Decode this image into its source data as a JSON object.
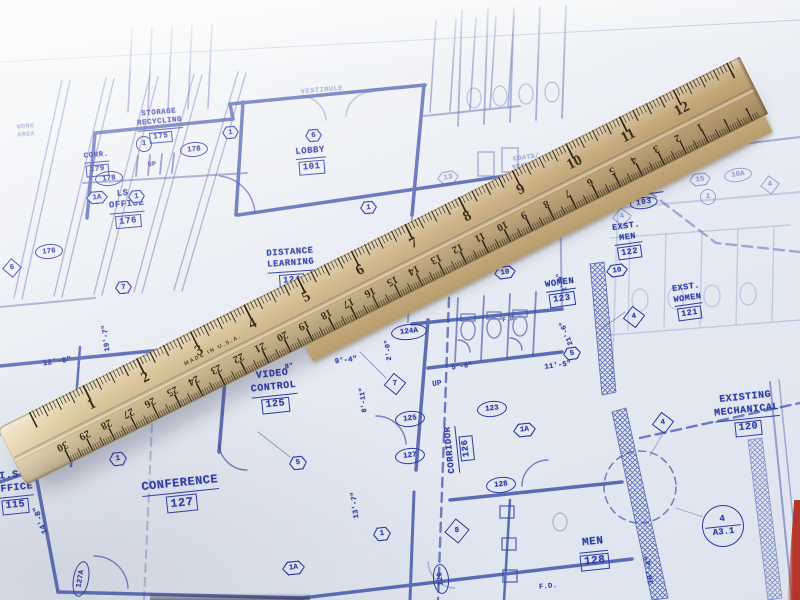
{
  "colors": {
    "paper": "#e8ecf4",
    "blueprint_line": "#3a4ea6",
    "blueprint_text": "#2b3ca6",
    "ruler_wood": "#d2bb8e",
    "ruler_wood_dark": "#b89c6e",
    "ruler_marking": "#33271a",
    "red_corner": "#b5352b"
  },
  "ruler": {
    "made_in": "MADE IN U.S.A.",
    "top_scale_numbers": [
      1,
      2,
      3,
      4,
      5,
      6,
      7,
      8,
      9,
      10,
      11,
      12
    ],
    "bottom_scale_numbers": [
      30,
      29,
      28,
      27,
      26,
      25,
      24,
      23,
      22,
      21,
      20,
      19,
      18,
      17,
      16,
      15,
      14,
      13,
      12,
      11,
      10,
      9,
      8,
      7,
      6,
      5,
      4,
      3,
      2,
      1
    ]
  },
  "blueprint": {
    "rooms": [
      {
        "lines": [
          "WORK",
          "AREA"
        ],
        "num": "",
        "num_style": "plain",
        "x": 26,
        "y": 131,
        "rot": -4,
        "size": 6.5,
        "faint": true
      },
      {
        "lines": [
          "STORAGE",
          "RECYCLING"
        ],
        "num": "175",
        "num_style": "box",
        "x": 160,
        "y": 126,
        "rot": -5,
        "size": 7.5,
        "faint": false
      },
      {
        "lines": [
          "CORR."
        ],
        "num": "179",
        "num_style": "box",
        "x": 97,
        "y": 164,
        "rot": -5,
        "size": 7.5,
        "faint": false
      },
      {
        "lines": [
          "LOBBY"
        ],
        "num": "101",
        "num_style": "box",
        "x": 311,
        "y": 160,
        "rot": -5,
        "size": 9,
        "faint": false
      },
      {
        "lines": [
          "VESTIBULE"
        ],
        "num": "",
        "num_style": "plain",
        "x": 322,
        "y": 91,
        "rot": -5,
        "size": 7,
        "faint": true
      },
      {
        "lines": [
          "LS.",
          "OFFICE"
        ],
        "num": "176",
        "num_style": "box",
        "x": 127,
        "y": 208,
        "rot": -5,
        "size": 9,
        "faint": false
      },
      {
        "lines": [
          "COATS/",
          "VENDING"
        ],
        "num": "",
        "num_style": "plain",
        "x": 527,
        "y": 162,
        "rot": -8,
        "size": 6.5,
        "faint": true
      },
      {
        "lines": [
          "DISTANCE",
          "LEARNING"
        ],
        "num": "124",
        "num_style": "box",
        "x": 291,
        "y": 267,
        "rot": -4,
        "size": 9,
        "faint": false
      },
      {
        "lines": [
          "VIDEO",
          "CONTROL"
        ],
        "num": "125",
        "num_style": "box",
        "x": 274,
        "y": 391,
        "rot": -6,
        "size": 10,
        "faint": false
      },
      {
        "lines": [
          "CONFERENCE"
        ],
        "num": "127",
        "num_style": "box",
        "x": 181,
        "y": 494,
        "rot": -6,
        "size": 12,
        "faint": false
      },
      {
        "lines": [
          "WOMEN"
        ],
        "num": "123",
        "num_style": "box",
        "x": 561,
        "y": 292,
        "rot": -8,
        "size": 9,
        "faint": false
      },
      {
        "lines": [
          "EXST.",
          "MEN"
        ],
        "num": "122",
        "num_style": "box",
        "x": 628,
        "y": 240,
        "rot": -8,
        "size": 8.5,
        "faint": false
      },
      {
        "lines": [
          "EXST.",
          "WOMEN"
        ],
        "num": "121",
        "num_style": "box",
        "x": 688,
        "y": 301,
        "rot": -8,
        "size": 8.5,
        "faint": false
      },
      {
        "lines": [
          "CORRIDOR"
        ],
        "num": "103",
        "num_style": "oval",
        "x": 643,
        "y": 196,
        "rot": -8,
        "size": 8,
        "faint": false
      },
      {
        "lines": [
          "EXISTING",
          "MECHANICAL"
        ],
        "num": "120",
        "num_style": "box",
        "x": 747,
        "y": 414,
        "rot": -6,
        "size": 10,
        "faint": false
      },
      {
        "lines": [
          "MEN"
        ],
        "num": "128",
        "num_style": "box",
        "x": 594,
        "y": 553,
        "rot": -6,
        "size": 11,
        "faint": false
      },
      {
        "lines": [
          "CORRIDOR"
        ],
        "num": "126",
        "num_style": "box",
        "x": 459,
        "y": 449,
        "rot": -96,
        "size": 9,
        "faint": false
      },
      {
        "lines": [
          "I.S.",
          "OFFICE"
        ],
        "num": "115",
        "num_style": "box",
        "x": 14,
        "y": 492,
        "rot": -6,
        "size": 10,
        "faint": false
      }
    ],
    "ref_tags": [
      {
        "shape": "oval",
        "text": "178",
        "x": 108,
        "y": 177,
        "w": 26,
        "h": 13,
        "rot": -5,
        "faint": false
      },
      {
        "shape": "oval",
        "text": "178",
        "x": 193,
        "y": 148,
        "w": 26,
        "h": 13,
        "rot": -5,
        "faint": false
      },
      {
        "shape": "oval",
        "text": "176",
        "x": 48,
        "y": 250,
        "w": 26,
        "h": 13,
        "rot": -5,
        "faint": false
      },
      {
        "shape": "oval",
        "text": "124A",
        "x": 408,
        "y": 331,
        "w": 34,
        "h": 14,
        "rot": -6,
        "faint": false
      },
      {
        "shape": "oval",
        "text": "125",
        "x": 409,
        "y": 418,
        "w": 28,
        "h": 14,
        "rot": -6,
        "faint": false
      },
      {
        "shape": "oval",
        "text": "127",
        "x": 409,
        "y": 455,
        "w": 28,
        "h": 14,
        "rot": -6,
        "faint": false
      },
      {
        "shape": "oval",
        "text": "123",
        "x": 491,
        "y": 408,
        "w": 28,
        "h": 14,
        "rot": -6,
        "faint": false
      },
      {
        "shape": "oval",
        "text": "128",
        "x": 500,
        "y": 484,
        "w": 28,
        "h": 14,
        "rot": -6,
        "faint": false
      },
      {
        "shape": "oval",
        "text": "126",
        "x": 440,
        "y": 578,
        "w": 28,
        "h": 14,
        "rot": -96,
        "faint": false
      },
      {
        "shape": "oval",
        "text": "127A",
        "x": 80,
        "y": 578,
        "w": 34,
        "h": 14,
        "rot": -80,
        "faint": false
      },
      {
        "shape": "oval",
        "text": "10A",
        "x": 737,
        "y": 174,
        "w": 26,
        "h": 12,
        "rot": -8,
        "faint": true
      },
      {
        "shape": "circle",
        "text": "1",
        "x": 143,
        "y": 143,
        "w": 14,
        "h": 14,
        "rot": 0,
        "faint": false
      },
      {
        "shape": "circle",
        "text": "1",
        "x": 707,
        "y": 196,
        "w": 14,
        "h": 14,
        "rot": 0,
        "faint": true
      },
      {
        "shape": "hex",
        "text": "1A",
        "x": 97,
        "y": 197,
        "w": 22,
        "h": 13,
        "rot": -5,
        "faint": false
      },
      {
        "shape": "hex",
        "text": "1",
        "x": 136,
        "y": 196,
        "w": 17,
        "h": 13,
        "rot": -5,
        "faint": false
      },
      {
        "shape": "hex",
        "text": "7",
        "x": 123,
        "y": 287,
        "w": 17,
        "h": 13,
        "rot": -5,
        "faint": false
      },
      {
        "shape": "hex",
        "text": "1",
        "x": 230,
        "y": 132,
        "w": 17,
        "h": 13,
        "rot": -5,
        "faint": false
      },
      {
        "shape": "hex",
        "text": "6",
        "x": 313,
        "y": 135,
        "w": 17,
        "h": 13,
        "rot": -5,
        "faint": false
      },
      {
        "shape": "hex",
        "text": "1",
        "x": 368,
        "y": 207,
        "w": 17,
        "h": 13,
        "rot": -5,
        "faint": false
      },
      {
        "shape": "hex",
        "text": "13",
        "x": 448,
        "y": 177,
        "w": 22,
        "h": 13,
        "rot": -8,
        "faint": true
      },
      {
        "shape": "hex",
        "text": "15",
        "x": 700,
        "y": 179,
        "w": 22,
        "h": 13,
        "rot": -8,
        "faint": true
      },
      {
        "shape": "hex",
        "text": "5",
        "x": 298,
        "y": 463,
        "w": 18,
        "h": 14,
        "rot": -6,
        "faint": false
      },
      {
        "shape": "hex",
        "text": "1",
        "x": 118,
        "y": 459,
        "w": 18,
        "h": 14,
        "rot": -6,
        "faint": false
      },
      {
        "shape": "hex",
        "text": "1",
        "x": 382,
        "y": 534,
        "w": 18,
        "h": 14,
        "rot": -6,
        "faint": false
      },
      {
        "shape": "hex",
        "text": "1A",
        "x": 293,
        "y": 568,
        "w": 23,
        "h": 14,
        "rot": -6,
        "faint": false
      },
      {
        "shape": "hex",
        "text": "10",
        "x": 505,
        "y": 272,
        "w": 22,
        "h": 13,
        "rot": -8,
        "faint": false
      },
      {
        "shape": "hex",
        "text": "10",
        "x": 617,
        "y": 270,
        "w": 22,
        "h": 13,
        "rot": -8,
        "faint": false
      },
      {
        "shape": "hex",
        "text": "5",
        "x": 572,
        "y": 353,
        "w": 18,
        "h": 13,
        "rot": -8,
        "faint": false
      },
      {
        "shape": "hex",
        "text": "1A",
        "x": 524,
        "y": 430,
        "w": 23,
        "h": 14,
        "rot": -6,
        "faint": false
      },
      {
        "shape": "diamond",
        "text": "7",
        "x": 395,
        "y": 384,
        "w": 20,
        "h": 20,
        "rot": -6,
        "faint": false
      },
      {
        "shape": "diamond",
        "text": "8",
        "x": 457,
        "y": 531,
        "w": 22,
        "h": 22,
        "rot": -6,
        "faint": false
      },
      {
        "shape": "diamond",
        "text": "4",
        "x": 634,
        "y": 317,
        "w": 20,
        "h": 20,
        "rot": -8,
        "faint": false
      },
      {
        "shape": "diamond",
        "text": "4",
        "x": 663,
        "y": 423,
        "w": 20,
        "h": 20,
        "rot": -8,
        "faint": false
      },
      {
        "shape": "diamond",
        "text": "4",
        "x": 770,
        "y": 185,
        "w": 18,
        "h": 18,
        "rot": -8,
        "faint": true
      },
      {
        "shape": "diamond",
        "text": "4",
        "x": 622,
        "y": 217,
        "w": 18,
        "h": 18,
        "rot": -8,
        "faint": true
      },
      {
        "shape": "diamond",
        "text": "6",
        "x": 12,
        "y": 268,
        "w": 18,
        "h": 18,
        "rot": -5,
        "faint": false
      },
      {
        "shape": "detail",
        "top": "4",
        "bottom": "A3.1",
        "x": 722,
        "y": 525,
        "w": 40,
        "h": 40,
        "rot": -6,
        "faint": false
      }
    ],
    "dimensions": [
      {
        "text": "12'-6\"",
        "x": 57,
        "y": 362,
        "rot": -8,
        "size": 8
      },
      {
        "text": "19'-7\"",
        "x": 107,
        "y": 338,
        "rot": -96,
        "size": 7.5
      },
      {
        "text": "14'-8\"",
        "x": 41,
        "y": 520,
        "rot": -110,
        "size": 8
      },
      {
        "text": "9'-4\"",
        "x": 346,
        "y": 361,
        "rot": -7,
        "size": 7.5
      },
      {
        "text": "8\"",
        "x": 289,
        "y": 367,
        "rot": -7,
        "size": 7
      },
      {
        "text": "2'-0\"",
        "x": 389,
        "y": 350,
        "rot": -96,
        "size": 7
      },
      {
        "text": "8'-11\"",
        "x": 364,
        "y": 400,
        "rot": -96,
        "size": 7
      },
      {
        "text": "13'-7\"",
        "x": 356,
        "y": 505,
        "rot": -96,
        "size": 7.5
      },
      {
        "text": "5'-8\"",
        "x": 462,
        "y": 367,
        "rot": -8,
        "size": 7
      },
      {
        "text": "11'-5\"",
        "x": 558,
        "y": 366,
        "rot": -8,
        "size": 7.5
      },
      {
        "text": "21'-6\"",
        "x": 567,
        "y": 333,
        "rot": -112,
        "size": 7
      },
      {
        "text": "2'-9\"",
        "x": 562,
        "y": 282,
        "rot": -112,
        "size": 6.5
      },
      {
        "text": "18'-4\"",
        "x": 650,
        "y": 570,
        "rot": -96,
        "size": 8
      }
    ],
    "misc_text": [
      {
        "text": "UP",
        "x": 152,
        "y": 165,
        "rot": -5,
        "size": 7,
        "faint": false
      },
      {
        "text": "UP",
        "x": 437,
        "y": 384,
        "rot": -6,
        "size": 8,
        "faint": false
      },
      {
        "text": "F.D.",
        "x": 510,
        "y": 319,
        "rot": -8,
        "size": 6.5,
        "faint": false
      },
      {
        "text": "F.D.",
        "x": 548,
        "y": 587,
        "rot": -6,
        "size": 7.5,
        "faint": false
      }
    ]
  }
}
